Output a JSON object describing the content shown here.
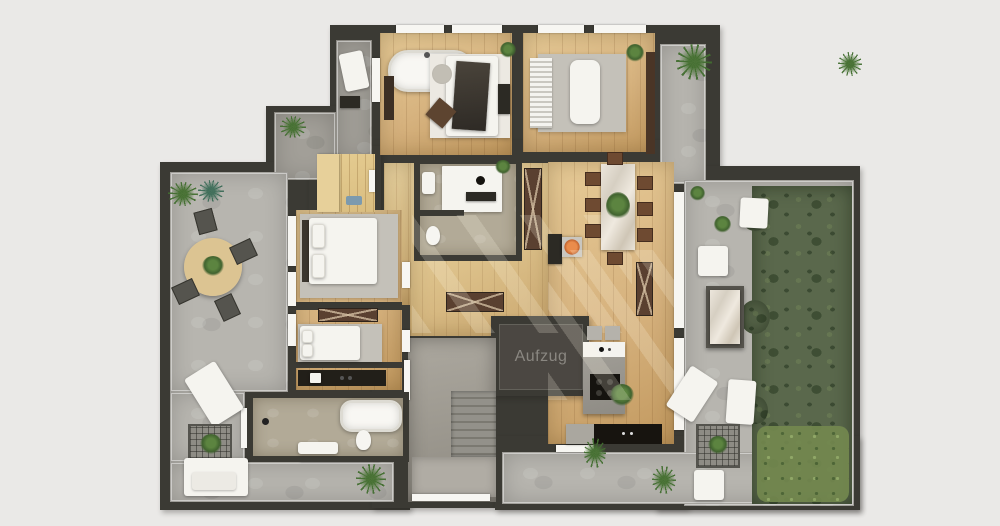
{
  "scene": {
    "type": "apartment-floor-plan-rendering",
    "background": "#eae9e7"
  },
  "labels": {
    "elevator": "Aufzug"
  },
  "colors": {
    "wall": "#3b3a34",
    "wood": "#d6b27e",
    "wood_dark": "#c2995f",
    "wood_light": "#e7cb97",
    "concrete": "#b7b5af",
    "concrete_dark": "#a29f98",
    "garden": "#5a684c",
    "garden_dark": "#46543b",
    "grass_light": "#74894f",
    "rug": "#c4c1b9",
    "brown": "#5a4030",
    "accent_fire": "#e0763f",
    "elevator_box": "#4b4742",
    "elevator_text": "#8a8781",
    "bath_floor": "#b2aa97",
    "sauna_wood": "#d9bd80"
  }
}
